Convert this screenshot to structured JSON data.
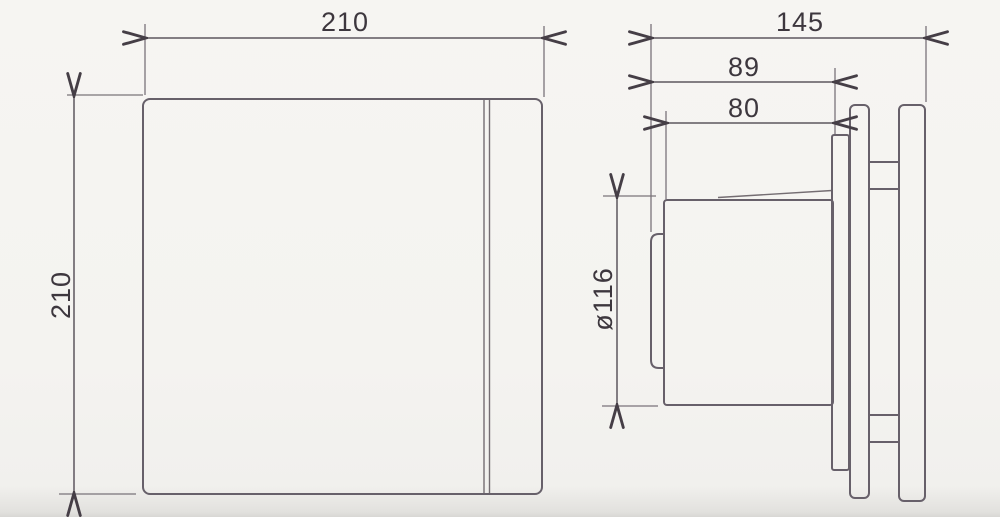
{
  "drawing": {
    "type": "technical-dimension-drawing",
    "subject": "square-extractor-fan-front-and-side-views",
    "front_view": {
      "width_label": "210",
      "height_label": "210"
    },
    "side_view": {
      "overall_depth_label": "145",
      "body_depth_label": "89",
      "spigot_depth_label": "80",
      "duct_diameter_label": "ø116"
    },
    "colors": {
      "background": "#f4f3f0",
      "line": "#67606a",
      "dimension_line": "#5d565e",
      "arrow": "#453e46",
      "text": "#3d373e"
    }
  }
}
